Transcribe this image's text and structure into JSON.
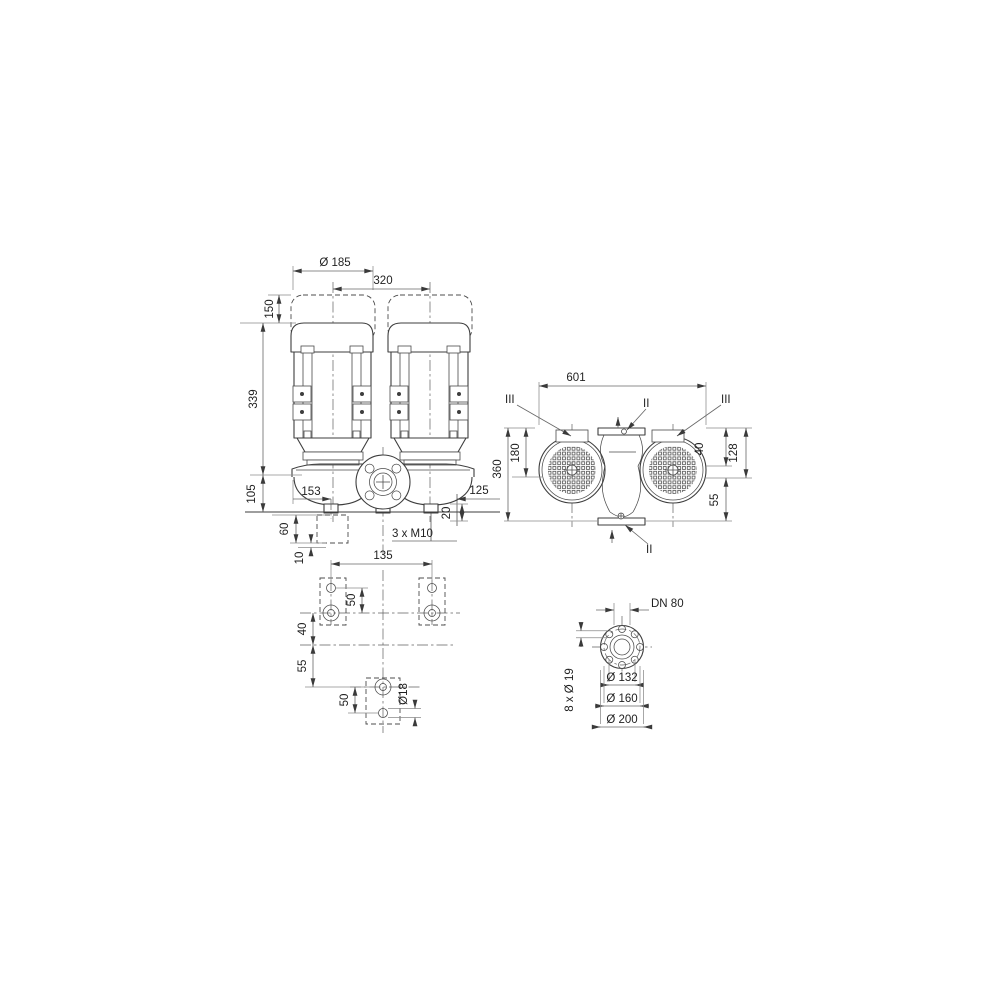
{
  "drawing": {
    "title": "double-pump dimensional drawing",
    "colors": {
      "background": "#ffffff",
      "object_line": "#3e3e3e",
      "dimension_line": "#666666",
      "text": "#1f1f1f"
    },
    "front": {
      "d185": "Ø 185",
      "d320": "320",
      "d150": "150",
      "d339": "339",
      "d105": "105",
      "d153": "153",
      "d60": "60",
      "d10": "10",
      "d125": "125",
      "d20": "20",
      "m10": "3 x M10"
    },
    "top": {
      "d601": "601",
      "d360": "360",
      "d180": "180",
      "d40": "40",
      "d128": "128",
      "d55": "55",
      "sec_ii": "II",
      "sec_iii": "III"
    },
    "foundation": {
      "d135": "135",
      "d50_top": "50",
      "d40": "40",
      "d55": "55",
      "d50_bottom": "50",
      "d18": "Ø18"
    },
    "flange": {
      "dn": "DN 80",
      "d132": "Ø 132",
      "d160": "Ø 160",
      "d200": "Ø 200",
      "bolts": "8 x Ø 19"
    }
  }
}
